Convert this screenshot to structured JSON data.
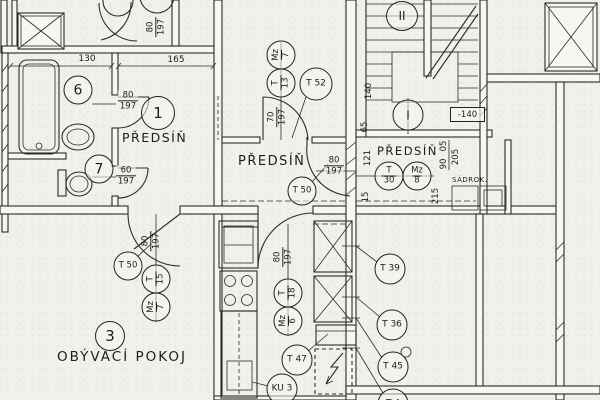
{
  "plan": {
    "rooms": {
      "hall_left": {
        "number": "1",
        "label": "PŘEDSÍŇ"
      },
      "hall_center": {
        "label": "PŘEDSÍŇ"
      },
      "hall_right": {
        "label": "PŘEDSÍŇ"
      },
      "bathroom": {
        "number": "6"
      },
      "wc": {
        "number": "7"
      },
      "living_room": {
        "number": "3",
        "label": "OBÝVACÍ POKOJ"
      },
      "staircase": {
        "upper_flight": "II",
        "lower_flight": "I",
        "level_mark": "-140"
      }
    },
    "door_tags": {
      "t52": "T 52",
      "t50_center": "T 50",
      "t50_left": "T 50",
      "t47": "T 47",
      "t39": "T 39",
      "t36": "T 36",
      "t45": "T 45",
      "t4_partial": "T 4",
      "ku3": "KU 3"
    },
    "frame_pairs": {
      "top": {
        "a": "Mz",
        "a_num": "7",
        "b": "T",
        "b_num": "13"
      },
      "left": {
        "a": "T",
        "a_num": "15",
        "b": "Mz",
        "b_num": "7"
      },
      "kitchen": {
        "a": "T",
        "a_num": "18",
        "b": "Mz",
        "b_num": "6"
      },
      "right": {
        "a": "T",
        "a_num": "30",
        "b": "Mz",
        "b_num": "8"
      }
    },
    "dimensions": {
      "width_130": "130",
      "width_165": "165",
      "door_bath": {
        "w": "80",
        "h": "197"
      },
      "door_wc": {
        "w": "60",
        "h": "197"
      },
      "door_top_left": {
        "w": "80",
        "h": "197"
      },
      "door_hall_top": {
        "w": "70",
        "h": "197"
      },
      "door_hall_center": {
        "w": "80",
        "h": "197"
      },
      "door_living": {
        "w": "80",
        "h": "197"
      },
      "door_kitchen": {
        "w": "80",
        "h": "197"
      },
      "v121": "121",
      "v15": "15",
      "v05": "05",
      "v90": "90",
      "v205": "205",
      "v215": "215",
      "v140": "140",
      "v65": "65"
    },
    "notes": {
      "sadrok": "SÁDROK."
    }
  }
}
